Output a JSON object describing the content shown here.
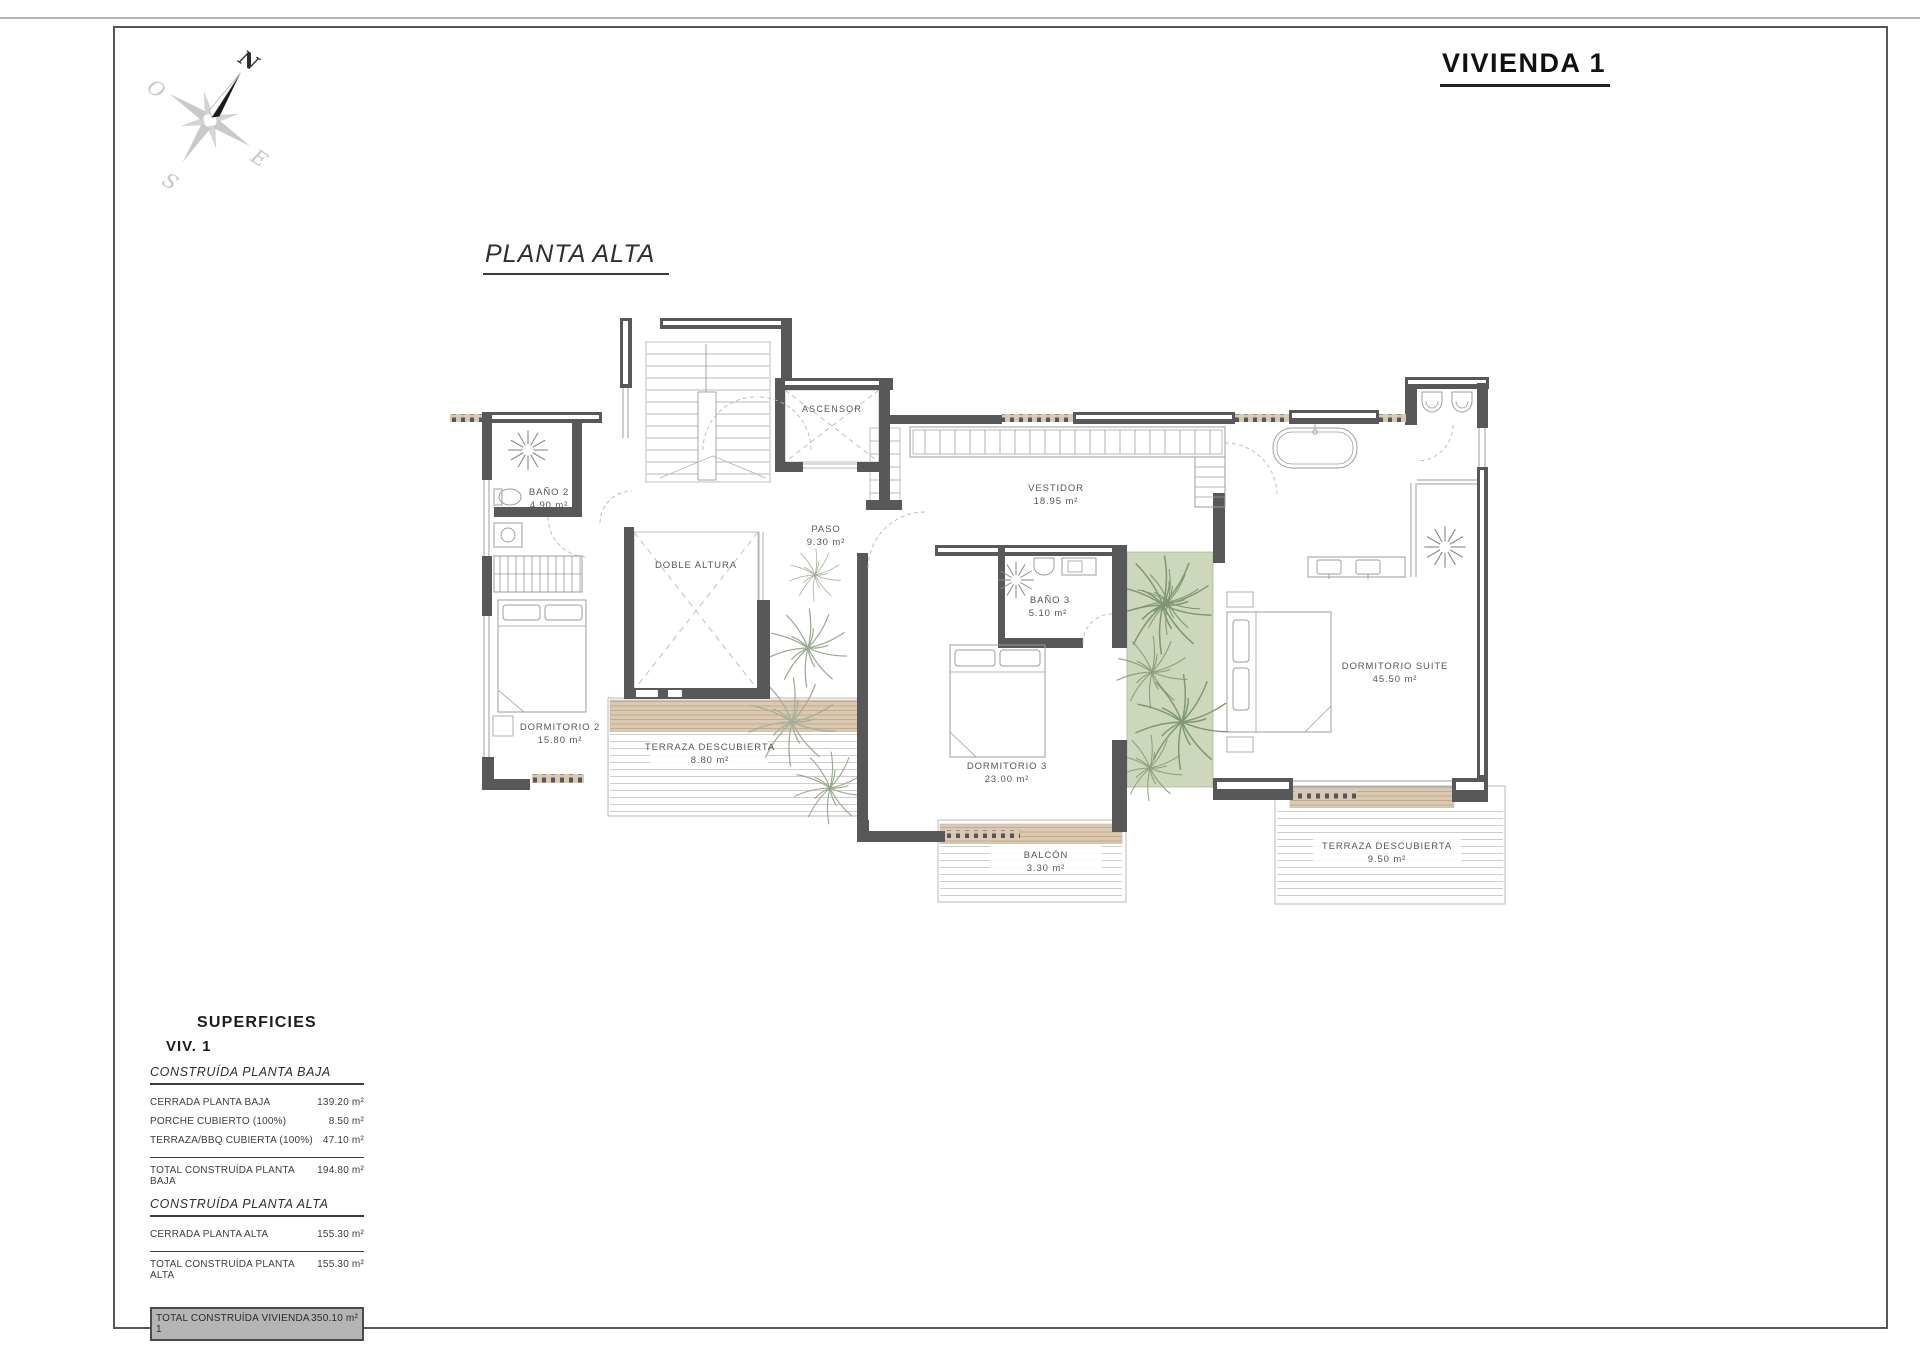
{
  "page": {
    "title": "VIVIENDA 1",
    "plan_label": "PLANTA ALTA"
  },
  "compass": {
    "north": "N",
    "south": "S",
    "east": "E",
    "west": "O"
  },
  "rooms": {
    "bano2": {
      "name": "BAÑO 2",
      "area": "4.90 m²"
    },
    "dormitorio2": {
      "name": "DORMITORIO 2",
      "area": "15.80 m²"
    },
    "terraza_izq": {
      "name": "TERRAZA DESCUBIERTA",
      "area": "8.80 m²"
    },
    "ascensor": {
      "name": "ASCENSOR"
    },
    "paso": {
      "name": "PASO",
      "area": "9.30 m²"
    },
    "doble_altura": {
      "name": "DOBLE ALTURA"
    },
    "vestidor": {
      "name": "VESTIDOR",
      "area": "18.95 m²"
    },
    "bano3": {
      "name": "BAÑO 3",
      "area": "5.10 m²"
    },
    "dormitorio3": {
      "name": "DORMITORIO 3",
      "area": "23.00 m²"
    },
    "balcon": {
      "name": "BALCÓN",
      "area": "3.30 m²"
    },
    "suite": {
      "name": "DORMITORIO SUITE",
      "area": "45.50 m²"
    },
    "terraza_der": {
      "name": "TERRAZA DESCUBIERTA",
      "area": "9.50 m²"
    }
  },
  "surfaces": {
    "heading": "SUPERFICIES",
    "subheading": "VIV. 1",
    "sections": [
      {
        "title": "CONSTRUÍDA PLANTA BAJA",
        "rows": [
          {
            "label": "CERRADA PLANTA BAJA",
            "value": "139.20 m²"
          },
          {
            "label": "PORCHE CUBIERTO (100%)",
            "value": "8.50 m²"
          },
          {
            "label": "TERRAZA/BBQ CUBIERTA (100%)",
            "value": "47.10 m²"
          }
        ],
        "total": {
          "label": "TOTAL CONSTRUÍDA PLANTA BAJA",
          "value": "194.80 m²"
        }
      },
      {
        "title": "CONSTRUÍDA PLANTA ALTA",
        "rows": [
          {
            "label": "CERRADA PLANTA ALTA",
            "value": "155.30 m²"
          }
        ],
        "total": {
          "label": "TOTAL CONSTRUÍDA PLANTA ALTA",
          "value": "155.30 m²"
        }
      }
    ],
    "grand_total": {
      "label": "TOTAL CONSTRUÍDA VIVIENDA 1",
      "value": "350.10 m²"
    }
  },
  "colors": {
    "wall": "#57585a",
    "wood": "#dcc9b2",
    "wood_line": "#bfa482",
    "green": "#ccd7bc",
    "plant_green": "#7f9770",
    "plant_gray": "#98a88e",
    "thin_line": "#b9b9b7",
    "highlight": "#b5b5b3"
  }
}
